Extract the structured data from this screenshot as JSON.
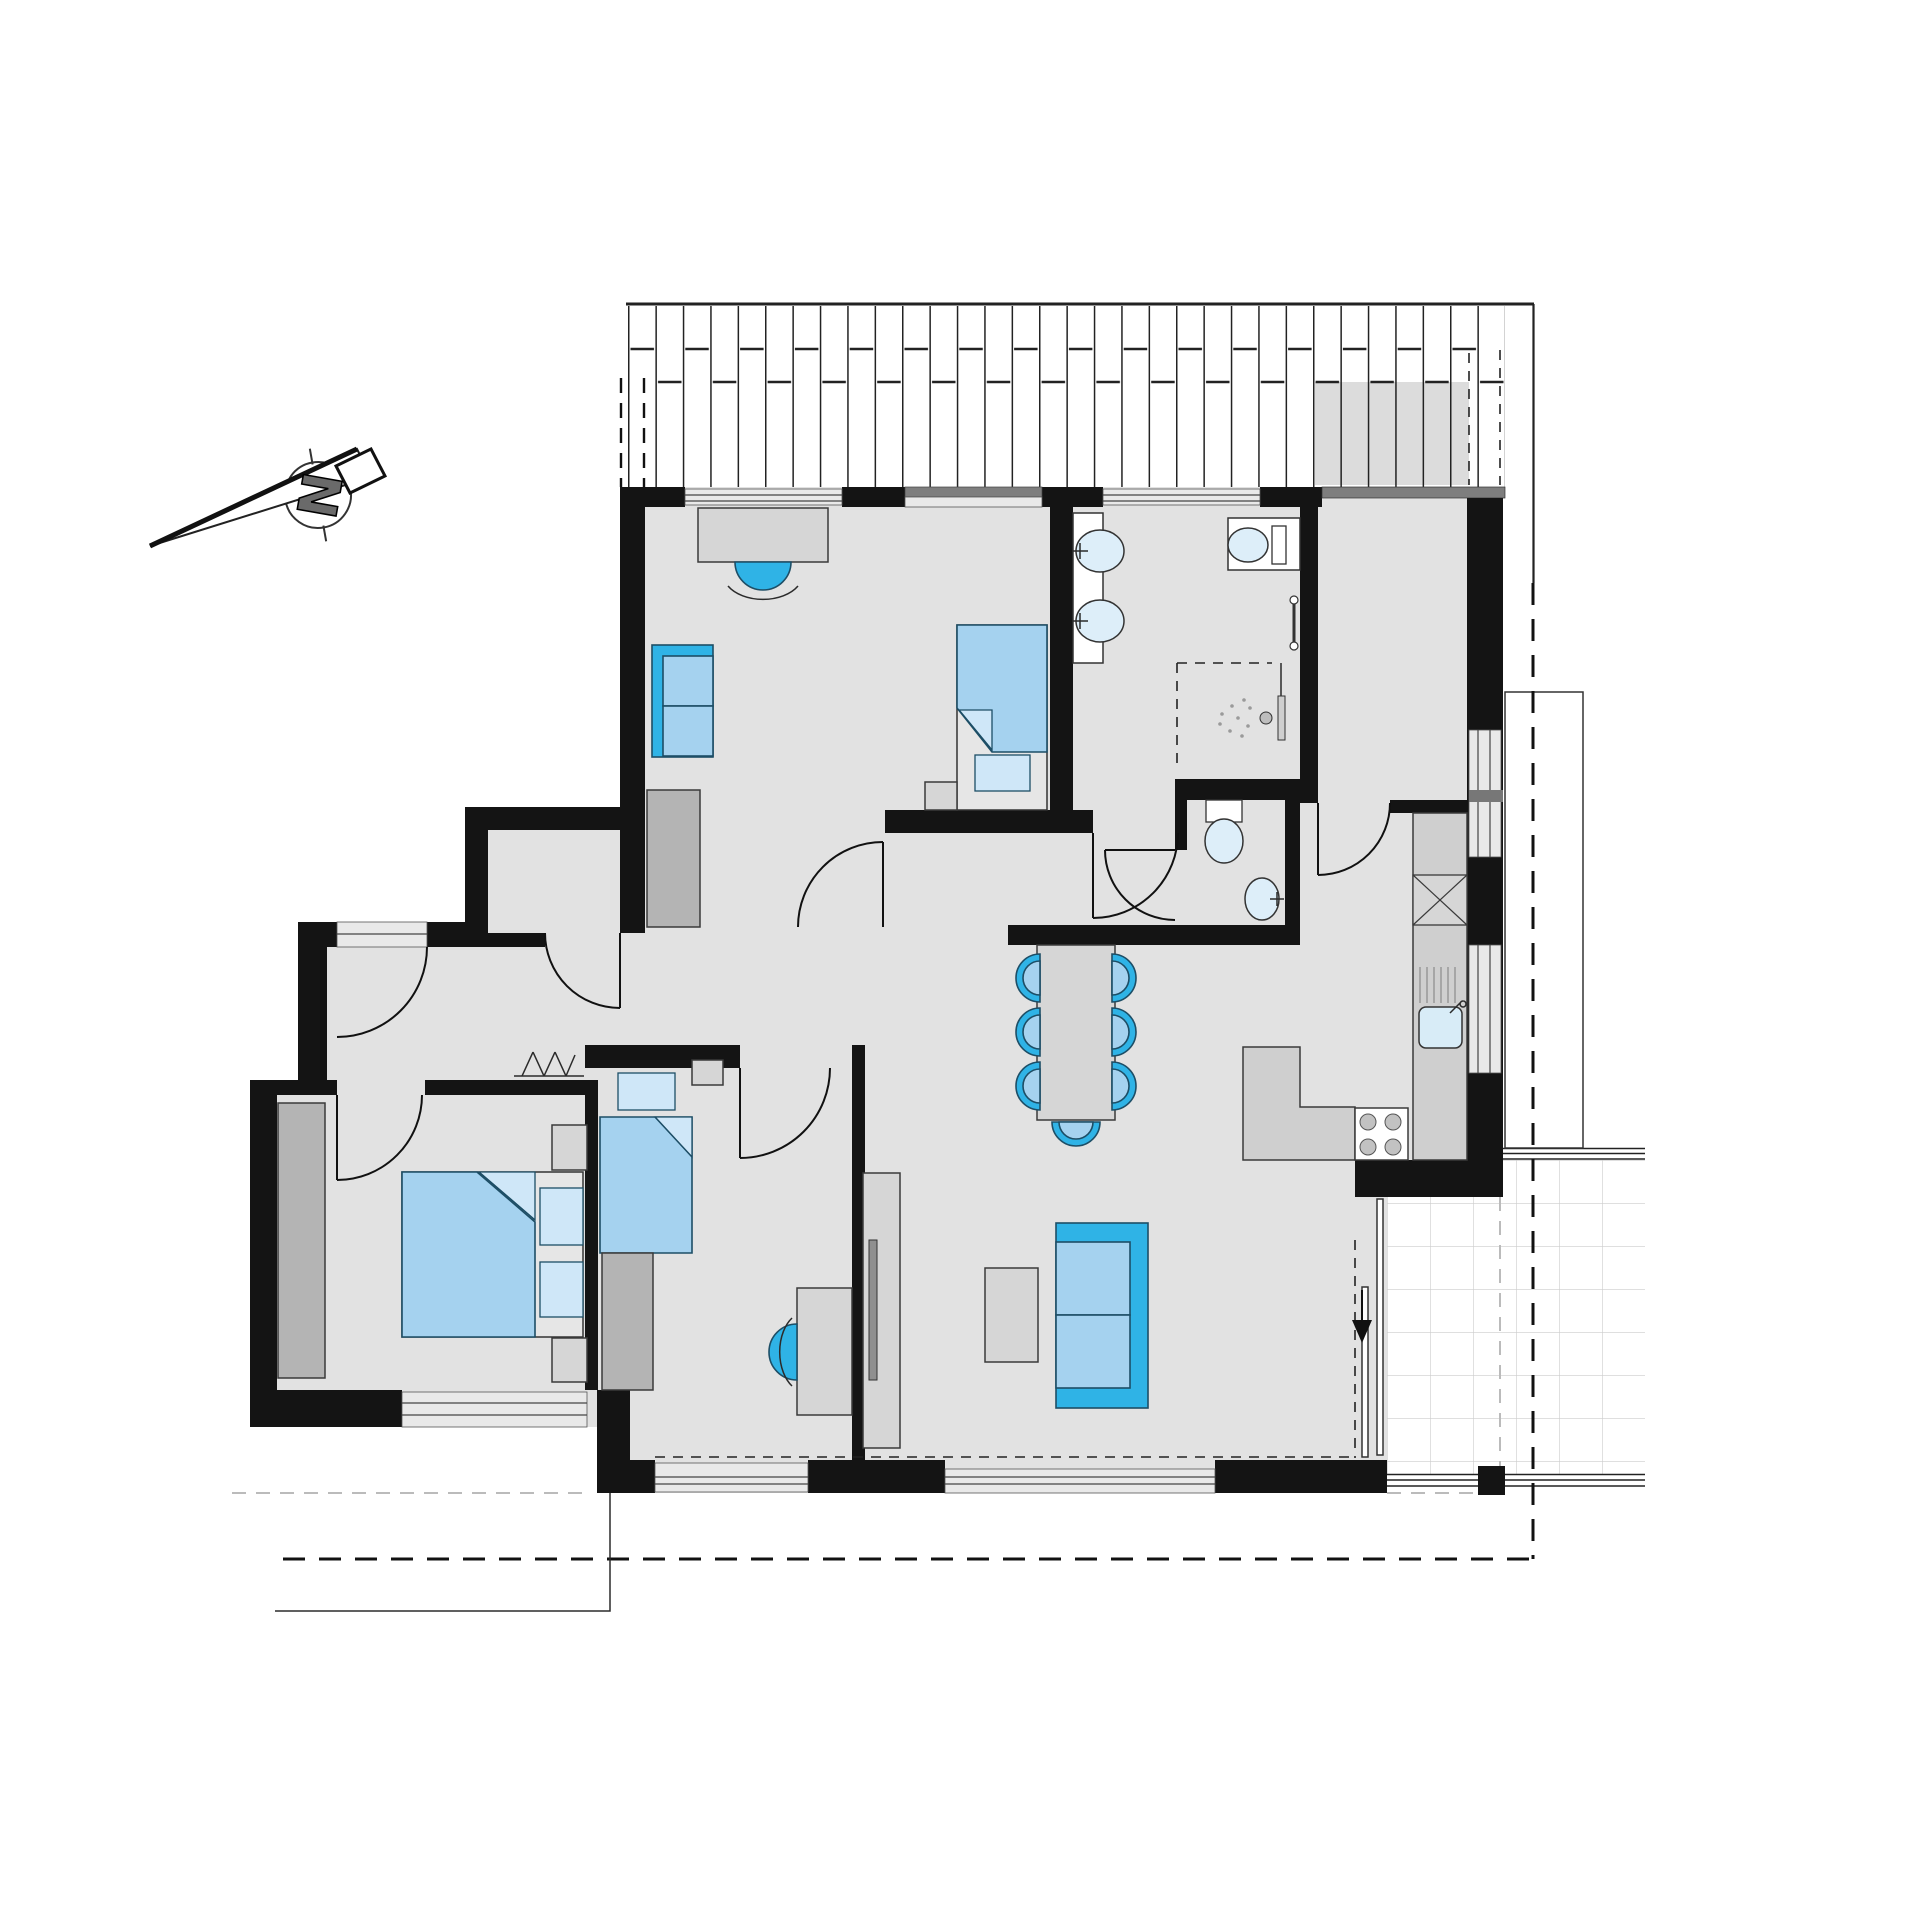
{
  "meta": {
    "type": "architectural-floor-plan",
    "description": "Apartment floor plan, top view, with furniture, pergola hatching at top, terrace grid bottom right"
  },
  "compass": {
    "letter": "N"
  },
  "colors": {
    "wall": "#141414",
    "floor": "#e2e2e2",
    "furn": "#d6d6d6",
    "furnStroke": "#3a3a3a",
    "wardrobe": "#b4b4b4",
    "accent": "#2fb3e6",
    "blueMid": "#a5d2ef",
    "blueLight": "#cfe7f8",
    "fixture": "#ddeef9",
    "counter": "#cfcfcf",
    "windowBand": "#e9e9e9",
    "darkBand": "#7e7e7e",
    "gridLine": "#cccccc",
    "tv": "#8f8f8f",
    "dashGray": "#bbbbbb",
    "letterGray": "#6a6a6a"
  },
  "rooms": [
    {
      "name": "study-bedroom"
    },
    {
      "name": "bathroom"
    },
    {
      "name": "wc"
    },
    {
      "name": "pantry"
    },
    {
      "name": "kitchen"
    },
    {
      "name": "dining-area"
    },
    {
      "name": "living-area"
    },
    {
      "name": "hallway"
    },
    {
      "name": "bedroom-middle"
    },
    {
      "name": "bedroom-left"
    },
    {
      "name": "terrace"
    }
  ],
  "furniture": [
    "desk",
    "desk-chair",
    "sofa-small",
    "single-bed",
    "double-bed",
    "wardrobe",
    "nightstand",
    "washbasin",
    "toilet",
    "shower",
    "kitchen-counter",
    "kitchen-sink",
    "cooktop",
    "fridge-box",
    "dining-table",
    "dining-chair",
    "sofa",
    "coffee-table",
    "tv-board"
  ]
}
